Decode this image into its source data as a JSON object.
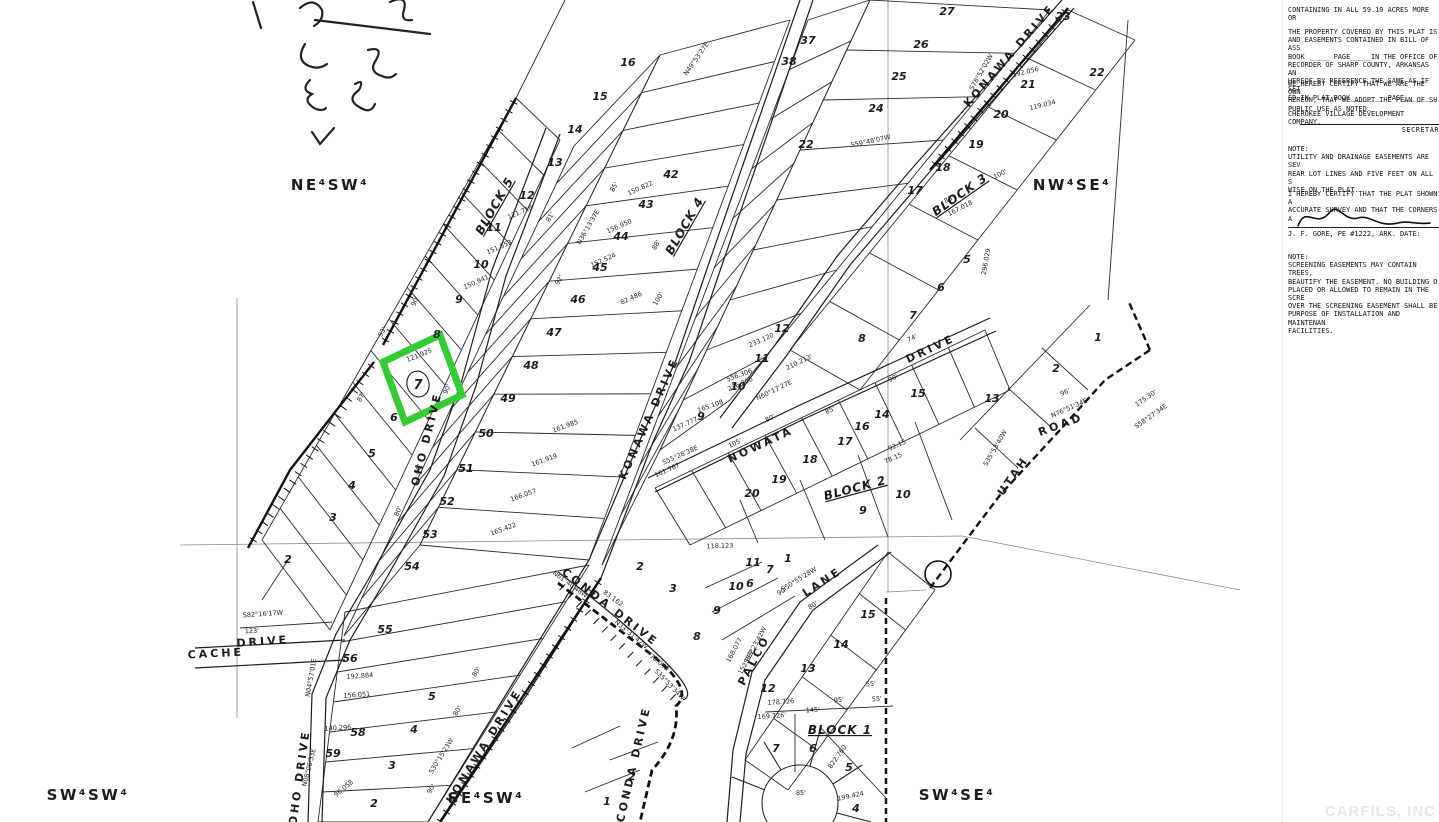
{
  "title": "Cherokee Village subdivision plat",
  "colors": {
    "highlight": "#35cb35",
    "ink": "#1c1c1c",
    "paper": "#ffffff",
    "watermark": "#e7e7e7"
  },
  "green_lot": {
    "lot_number": "7",
    "frontage": "121.925"
  },
  "watermark": "CARFILS, INC",
  "map": {
    "quarters": [
      [
        "NE⁴SW⁴",
        330,
        190
      ],
      [
        "NW⁴SE⁴",
        1072,
        190
      ],
      [
        "SW⁴SW⁴",
        88,
        800
      ],
      [
        "SE⁴SW⁴",
        486,
        803
      ],
      [
        "SW⁴SE⁴",
        957,
        800
      ]
    ],
    "streets": [
      [
        "KONAWA DRIVE",
        1012,
        58,
        -49
      ],
      [
        "KONAWA DRIVE",
        652,
        420,
        -66
      ],
      [
        "KONAWA DRIVE",
        487,
        748,
        -58
      ],
      [
        "OHO DRIVE",
        430,
        440,
        -76
      ],
      [
        "OHO DRIVE",
        303,
        778,
        -82
      ],
      [
        "NOWATA",
        762,
        448,
        -25
      ],
      [
        "DRIVE",
        932,
        352,
        -25
      ],
      [
        "UTAH",
        1016,
        478,
        -55
      ],
      [
        "ROAD",
        1062,
        428,
        -20
      ],
      [
        "CACHE",
        216,
        657,
        -3
      ],
      [
        "DRIVE",
        263,
        645,
        -4
      ],
      [
        "CONDA DRIVE",
        608,
        610,
        38
      ],
      [
        "CONDA DRIVE",
        637,
        765,
        -77
      ],
      [
        "PALCO",
        757,
        662,
        -62
      ],
      [
        "LANE",
        824,
        585,
        -33
      ]
    ],
    "blocks": [
      [
        "BLOCK 5",
        498,
        208,
        -60
      ],
      [
        "BLOCK 4",
        688,
        228,
        -60
      ],
      [
        "BLOCK 3",
        962,
        198,
        -35
      ],
      [
        "BLOCK 2",
        856,
        492,
        -15
      ],
      [
        "BLOCK 1",
        840,
        734,
        0
      ]
    ],
    "lots": [
      [
        "16",
        628,
        66
      ],
      [
        "15",
        600,
        100
      ],
      [
        "14",
        575,
        133
      ],
      [
        "13",
        555,
        166
      ],
      [
        "12",
        527,
        199
      ],
      [
        "11",
        494,
        231
      ],
      [
        "10",
        481,
        268
      ],
      [
        "9",
        459,
        303
      ],
      [
        "8",
        437,
        338
      ],
      [
        "6",
        394,
        421
      ],
      [
        "5",
        372,
        457
      ],
      [
        "4",
        352,
        489
      ],
      [
        "3",
        333,
        521
      ],
      [
        "2",
        288,
        563
      ],
      [
        "42",
        671,
        178
      ],
      [
        "43",
        646,
        208
      ],
      [
        "44",
        621,
        240
      ],
      [
        "45",
        600,
        271
      ],
      [
        "46",
        578,
        303
      ],
      [
        "47",
        554,
        336
      ],
      [
        "48",
        531,
        369
      ],
      [
        "49",
        508,
        402
      ],
      [
        "50",
        486,
        437
      ],
      [
        "51",
        466,
        472
      ],
      [
        "52",
        447,
        505
      ],
      [
        "53",
        430,
        538
      ],
      [
        "54",
        412,
        570
      ],
      [
        "55",
        385,
        633
      ],
      [
        "56",
        350,
        662
      ],
      [
        "58",
        358,
        736
      ],
      [
        "59",
        333,
        757
      ],
      [
        "37",
        808,
        44
      ],
      [
        "38",
        789,
        65
      ],
      [
        "27",
        947,
        15
      ],
      [
        "26",
        921,
        48
      ],
      [
        "25",
        899,
        80
      ],
      [
        "24",
        876,
        112
      ],
      [
        "23",
        1063,
        20
      ],
      [
        "22",
        1097,
        76
      ],
      [
        "21",
        1028,
        88
      ],
      [
        "20",
        1001,
        118
      ],
      [
        "19",
        976,
        148
      ],
      [
        "18",
        943,
        171
      ],
      [
        "17",
        915,
        194
      ],
      [
        "22",
        806,
        148
      ],
      [
        "1",
        1098,
        341
      ],
      [
        "2",
        1056,
        372
      ],
      [
        "13",
        992,
        402
      ],
      [
        "12",
        782,
        332
      ],
      [
        "11",
        762,
        362
      ],
      [
        "10",
        738,
        390
      ],
      [
        "9",
        701,
        420
      ],
      [
        "8",
        862,
        342
      ],
      [
        "5",
        967,
        263
      ],
      [
        "6",
        941,
        291
      ],
      [
        "7",
        913,
        319
      ],
      [
        "14",
        882,
        418
      ],
      [
        "15",
        918,
        397
      ],
      [
        "16",
        862,
        430
      ],
      [
        "17",
        845,
        445
      ],
      [
        "18",
        810,
        463
      ],
      [
        "19",
        779,
        483
      ],
      [
        "20",
        752,
        497
      ],
      [
        "9",
        863,
        514
      ],
      [
        "10",
        903,
        498
      ],
      [
        "2",
        640,
        570
      ],
      [
        "3",
        673,
        592
      ],
      [
        "1",
        788,
        562
      ],
      [
        "6",
        750,
        587
      ],
      [
        "7",
        770,
        573
      ],
      [
        "12",
        768,
        692
      ],
      [
        "13",
        808,
        672
      ],
      [
        "14",
        841,
        648
      ],
      [
        "15",
        868,
        618
      ],
      [
        "8",
        697,
        640
      ],
      [
        "9",
        717,
        614
      ],
      [
        "10",
        736,
        590
      ],
      [
        "11",
        753,
        566
      ],
      [
        "4",
        856,
        812
      ],
      [
        "5",
        849,
        771
      ],
      [
        "6",
        813,
        752
      ],
      [
        "7",
        776,
        752
      ],
      [
        "5",
        432,
        700
      ],
      [
        "4",
        414,
        733
      ],
      [
        "1",
        607,
        805
      ],
      [
        "2",
        632,
        780
      ],
      [
        "3",
        392,
        769
      ],
      [
        "2",
        374,
        807
      ]
    ],
    "dims": [
      [
        "93'",
        384,
        333,
        -60
      ],
      [
        "87'",
        363,
        398,
        -60
      ],
      [
        "90'",
        449,
        390,
        -68
      ],
      [
        "90'",
        417,
        302,
        -68
      ],
      [
        "80'",
        420,
        470,
        -68
      ],
      [
        "80'",
        400,
        512,
        -68
      ],
      [
        "161.919",
        545,
        462,
        -20
      ],
      [
        "166.057",
        524,
        497,
        -20
      ],
      [
        "165.422",
        504,
        531,
        -20
      ],
      [
        "161.985",
        566,
        428,
        -20
      ],
      [
        "121.718",
        521,
        214,
        -24
      ],
      [
        "151.553",
        500,
        249,
        -24
      ],
      [
        "150.941",
        477,
        284,
        -24
      ],
      [
        "150.822",
        641,
        190,
        -24
      ],
      [
        "156.950",
        620,
        228,
        -24
      ],
      [
        "152.524",
        604,
        262,
        -24
      ],
      [
        "N36°13'37E",
        590,
        228,
        -60
      ],
      [
        "92'",
        561,
        281,
        -60
      ],
      [
        "85'",
        616,
        188,
        -60
      ],
      [
        "81'",
        552,
        218,
        -60
      ],
      [
        "88'",
        658,
        246,
        -60
      ],
      [
        "82.486",
        632,
        300,
        -24
      ],
      [
        "100'",
        660,
        300,
        -60
      ],
      [
        "210.213'",
        800,
        364,
        -26
      ],
      [
        "N60°17'27E",
        775,
        392,
        -26
      ],
      [
        "233.120",
        762,
        342,
        -24
      ],
      [
        "236.306",
        741,
        386,
        -24
      ],
      [
        "85'",
        831,
        412,
        -26
      ],
      [
        "80'",
        771,
        420,
        -26
      ],
      [
        "90'",
        894,
        380,
        -26
      ],
      [
        "74'",
        913,
        340,
        -26
      ],
      [
        "92.15",
        898,
        447,
        -24
      ],
      [
        "78.15",
        894,
        460,
        -24
      ],
      [
        "105'",
        736,
        445,
        -26
      ],
      [
        "137.777",
        686,
        426,
        -24
      ],
      [
        "S55°28'38E",
        681,
        457,
        -24
      ],
      [
        "161.767",
        668,
        472,
        -24
      ],
      [
        "165.108",
        711,
        408,
        -20
      ],
      [
        "556.306",
        740,
        377,
        -20
      ],
      [
        "118.123",
        720,
        548,
        -2
      ],
      [
        "123'",
        252,
        633,
        -2
      ],
      [
        "S82°16'17W",
        263,
        616,
        -4
      ],
      [
        "N04°57'01E",
        313,
        678,
        -80
      ],
      [
        "83.162",
        612,
        600,
        36
      ],
      [
        "N61°40'48W",
        569,
        586,
        36
      ],
      [
        "N33°31'42W",
        630,
        636,
        40
      ],
      [
        "S35°53'34W",
        668,
        686,
        46
      ],
      [
        "78.048",
        658,
        664,
        40
      ],
      [
        "S50°55'28W",
        800,
        581,
        -32
      ],
      [
        "90'",
        783,
        593,
        -32
      ],
      [
        "S33°23'42W",
        757,
        646,
        -62
      ],
      [
        "152.882",
        748,
        663,
        -62
      ],
      [
        "168.077",
        736,
        651,
        -62
      ],
      [
        "80'",
        814,
        607,
        -33
      ],
      [
        "178.726",
        781,
        704,
        -4
      ],
      [
        "169.726'",
        772,
        718,
        -4
      ],
      [
        "145'",
        813,
        712,
        -4
      ],
      [
        "95'",
        839,
        702,
        -4
      ],
      [
        "55'",
        871,
        686,
        -4
      ],
      [
        "55'",
        877,
        701,
        -4
      ],
      [
        "822.760",
        839,
        758,
        -55
      ],
      [
        "199.424",
        851,
        798,
        -12
      ],
      [
        "85'",
        801,
        795,
        -2
      ],
      [
        "N76°51'34E",
        1070,
        410,
        -24
      ],
      [
        "96'",
        1066,
        394,
        -24
      ],
      [
        "S35°53'40W",
        997,
        449,
        -60
      ],
      [
        "296.029",
        988,
        262,
        -80
      ],
      [
        "167.018",
        961,
        210,
        -27
      ],
      [
        "83'",
        950,
        201,
        -27
      ],
      [
        "100'",
        1001,
        176,
        -27
      ],
      [
        "192.056",
        1026,
        74,
        -14
      ],
      [
        "119.034",
        1043,
        107,
        -14
      ],
      [
        "S78°52'02W",
        983,
        73,
        -60
      ],
      [
        "S59°48'07W",
        871,
        143,
        -12
      ],
      [
        "N49°53'27E",
        698,
        60,
        -55
      ],
      [
        "140.296",
        338,
        730,
        -3
      ],
      [
        "N08°06'53E",
        311,
        768,
        -76
      ],
      [
        "96.058",
        345,
        790,
        -40
      ],
      [
        "156.051",
        357,
        697,
        -4
      ],
      [
        "192.884",
        360,
        678,
        -4
      ],
      [
        "S30°15'23W",
        443,
        757,
        -58
      ],
      [
        "80'",
        459,
        712,
        -58
      ],
      [
        "80'",
        478,
        673,
        -58
      ],
      [
        "90'",
        433,
        790,
        -58
      ],
      [
        "175.30'",
        1147,
        400,
        -35
      ],
      [
        "S58°27'34E",
        1152,
        418,
        -35
      ]
    ]
  },
  "panel": {
    "containing": "CONTAINING IN ALL 59.10 ACRES MORE OR",
    "p1": [
      "THE PROPERTY COVERED BY THIS  PLAT IS",
      "AND EASEMENTS CONTAINED IN BILL OF ASS",
      "BOOK _____ PAGE_____IN  THE OFFICE OF",
      "RECORDER OF SHARP COUNTY, ARKANSAS  AN",
      "HEREOF BY REFERENCE THE SAME AS IF SET",
      "ED IN PLAT BOOK________ PAGE_______."
    ],
    "p2": [
      "WE HEREBY CERTIFY THAT WE ARE  THE OWN",
      "HEREON, THAT  WE ADOPT  THE PLAN OF SU",
      "PUBLIC USE AS NOTED."
    ],
    "p3": "CHEROKEE VILLAGE DEVELOPMENT COMPANY,",
    "secretary": "SECRETAR",
    "note1": [
      "NOTE:",
      "UTILITY AND DRAINAGE EASEMENTS ARE SEV",
      "REAR LOT LINES AND  FIVE FEET ON ALL S",
      "WISE ON THE PLAT."
    ],
    "cert": [
      "I HEREBY CERTIFY THAT THE PLAT SHOWN A",
      "ACCURATE SURVEY AND THAT THE CORNERS A"
    ],
    "sig_line": "J. F. GORE, PE #1222, ARK.     DATE:",
    "note2": [
      "NOTE:",
      "SCREENING EASEMENTS MAY CONTAIN TREES,",
      "BEAUTIFY  THE EASEMENT.  NO BUILDING  O",
      "PLACED OR ALLOWED TO REMAIN IN THE SCRE",
      "OVER THE  SCREENING EASEMENT  SHALL BE",
      "PURPOSE OF  INSTALLATION AND  MAINTENAN",
      "FACILITIES."
    ]
  }
}
